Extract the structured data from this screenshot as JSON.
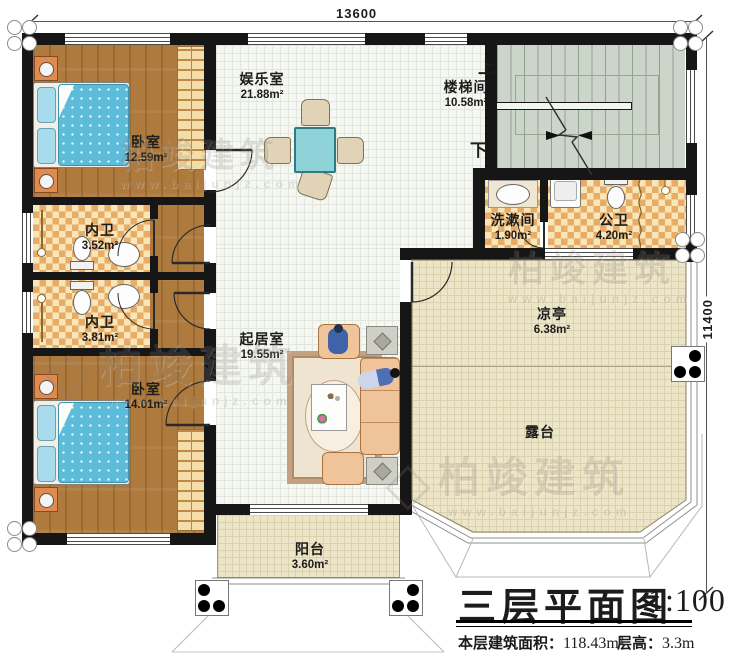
{
  "plan": {
    "dim_top": "13600",
    "dim_right": "11400",
    "stair_up": "上",
    "stair_down": "下",
    "rooms": {
      "bedroom1": {
        "name": "卧室",
        "area": "12.59m²"
      },
      "innerbath1": {
        "name": "内卫",
        "area": "3.52m²"
      },
      "innerbath2": {
        "name": "内卫",
        "area": "3.81m²"
      },
      "bedroom2": {
        "name": "卧室",
        "area": "14.01m²"
      },
      "recreation": {
        "name": "娱乐室",
        "area": "21.88m²"
      },
      "stairhall": {
        "name": "楼梯间",
        "area": "10.58m²"
      },
      "washroom": {
        "name": "洗漱间",
        "area": "1.90m²"
      },
      "publicbath": {
        "name": "公卫",
        "area": "4.20m²"
      },
      "livingroom": {
        "name": "起居室",
        "area": "19.55m²"
      },
      "pavilion": {
        "name": "凉亭",
        "area": "6.38m²"
      },
      "terrace": {
        "name": "露台"
      },
      "balcony": {
        "name": "阳台",
        "area": "3.60m²"
      }
    }
  },
  "title_block": {
    "title": "三层平面图",
    "scale": "1:100",
    "floor_area_label": "本层建筑面积：",
    "floor_area_value": "118.43m²",
    "floor_height_label": "层高：",
    "floor_height_value": "3.3m"
  },
  "watermark": {
    "brand": "柏竣建筑",
    "url": "www.baijunjz.com"
  },
  "colors": {
    "wall": "#161616",
    "wood_floor": "#ae7a3e",
    "tile_light": "#f8e5b8",
    "tile_dark": "#e7ac66",
    "stair_floor": "#ccd5ca",
    "terrace_floor": "#ece5c8",
    "bed_quilt": "#5cbcd9",
    "table_teal": "#8fd2d8"
  }
}
